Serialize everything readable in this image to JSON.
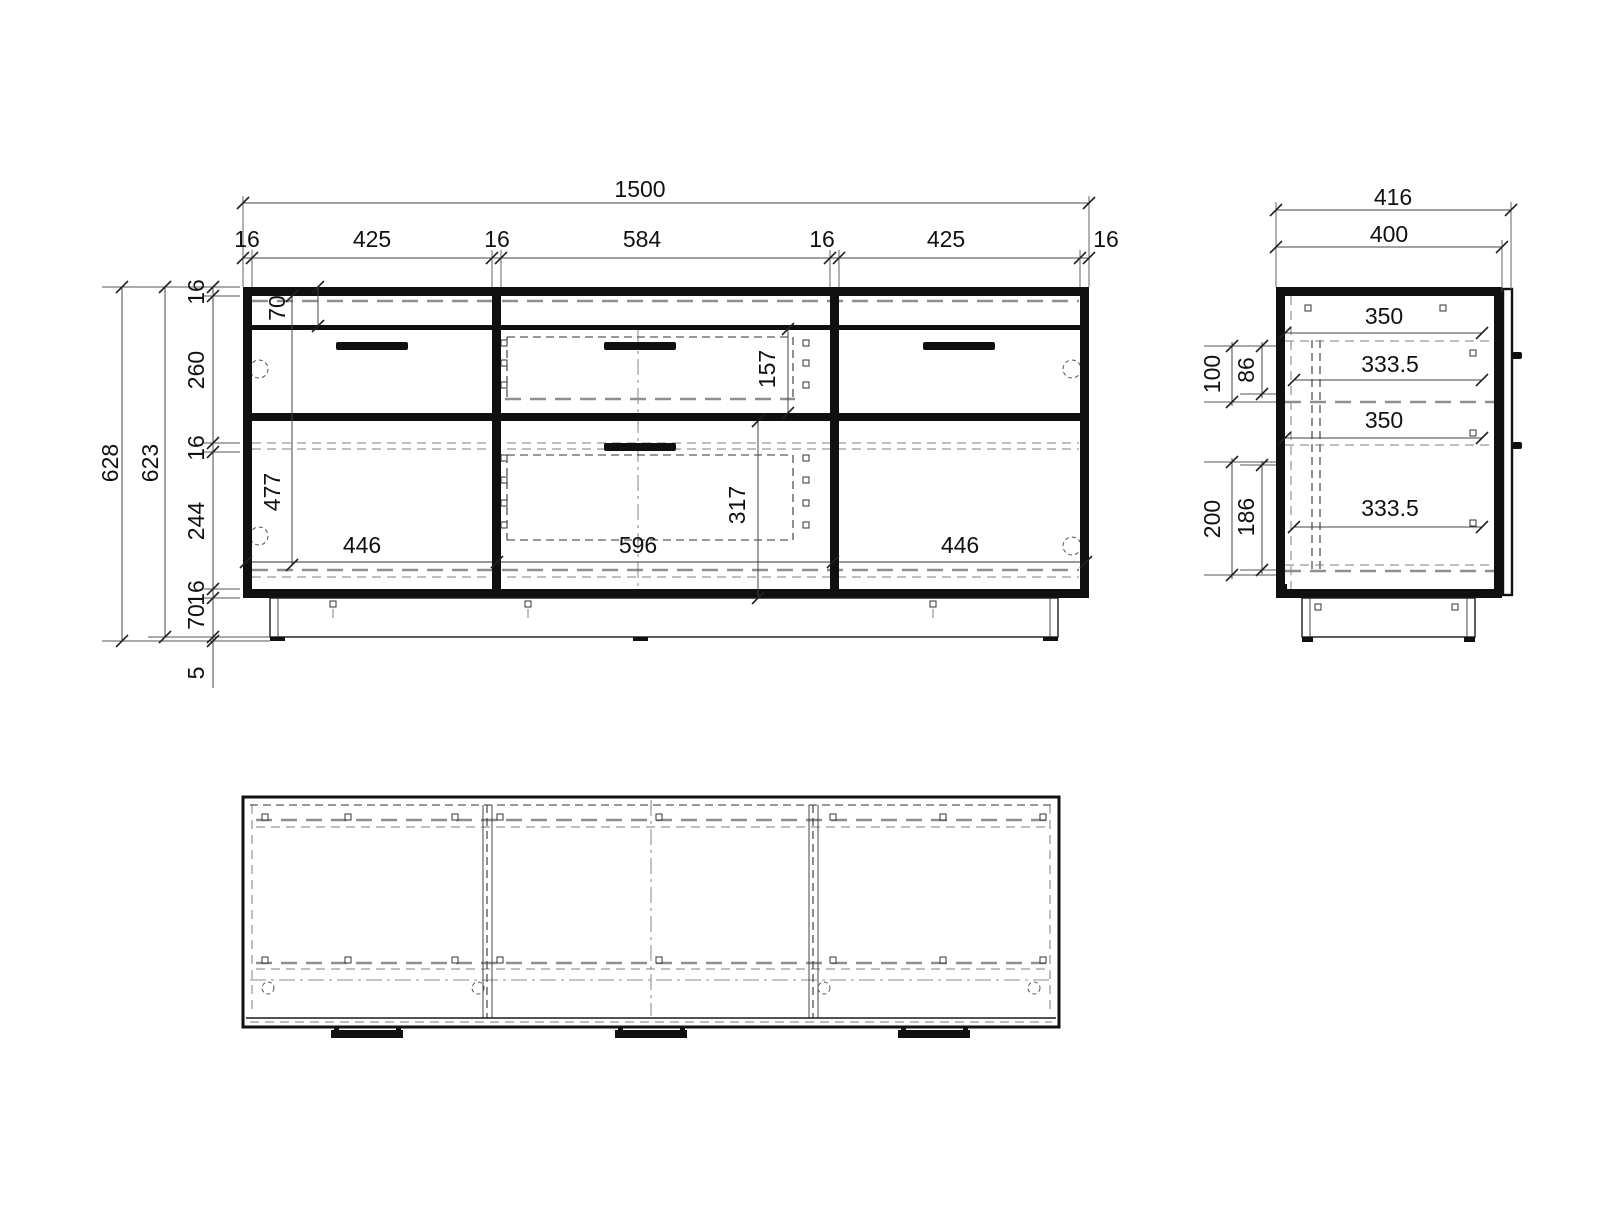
{
  "front": {
    "total_width": "1500",
    "segments": [
      "16",
      "425",
      "16",
      "584",
      "16",
      "425",
      "16"
    ],
    "total_height": "628",
    "inner_height": "623",
    "v_segments": [
      "16",
      "260",
      "16",
      "244",
      "16",
      "70",
      "5"
    ],
    "top_rail": "70",
    "drawer_front_h": "157",
    "left_door_h": "477",
    "mid_door_h": "317",
    "left_door_w": "446",
    "mid_door_w": "596",
    "right_door_w": "446"
  },
  "side": {
    "total_depth": "416",
    "body_depth": "400",
    "internal_widths": [
      "350",
      "333.5",
      "350",
      "333.5"
    ],
    "upper_outer": "100",
    "upper_inner": "86",
    "lower_outer": "200",
    "lower_inner": "186"
  }
}
